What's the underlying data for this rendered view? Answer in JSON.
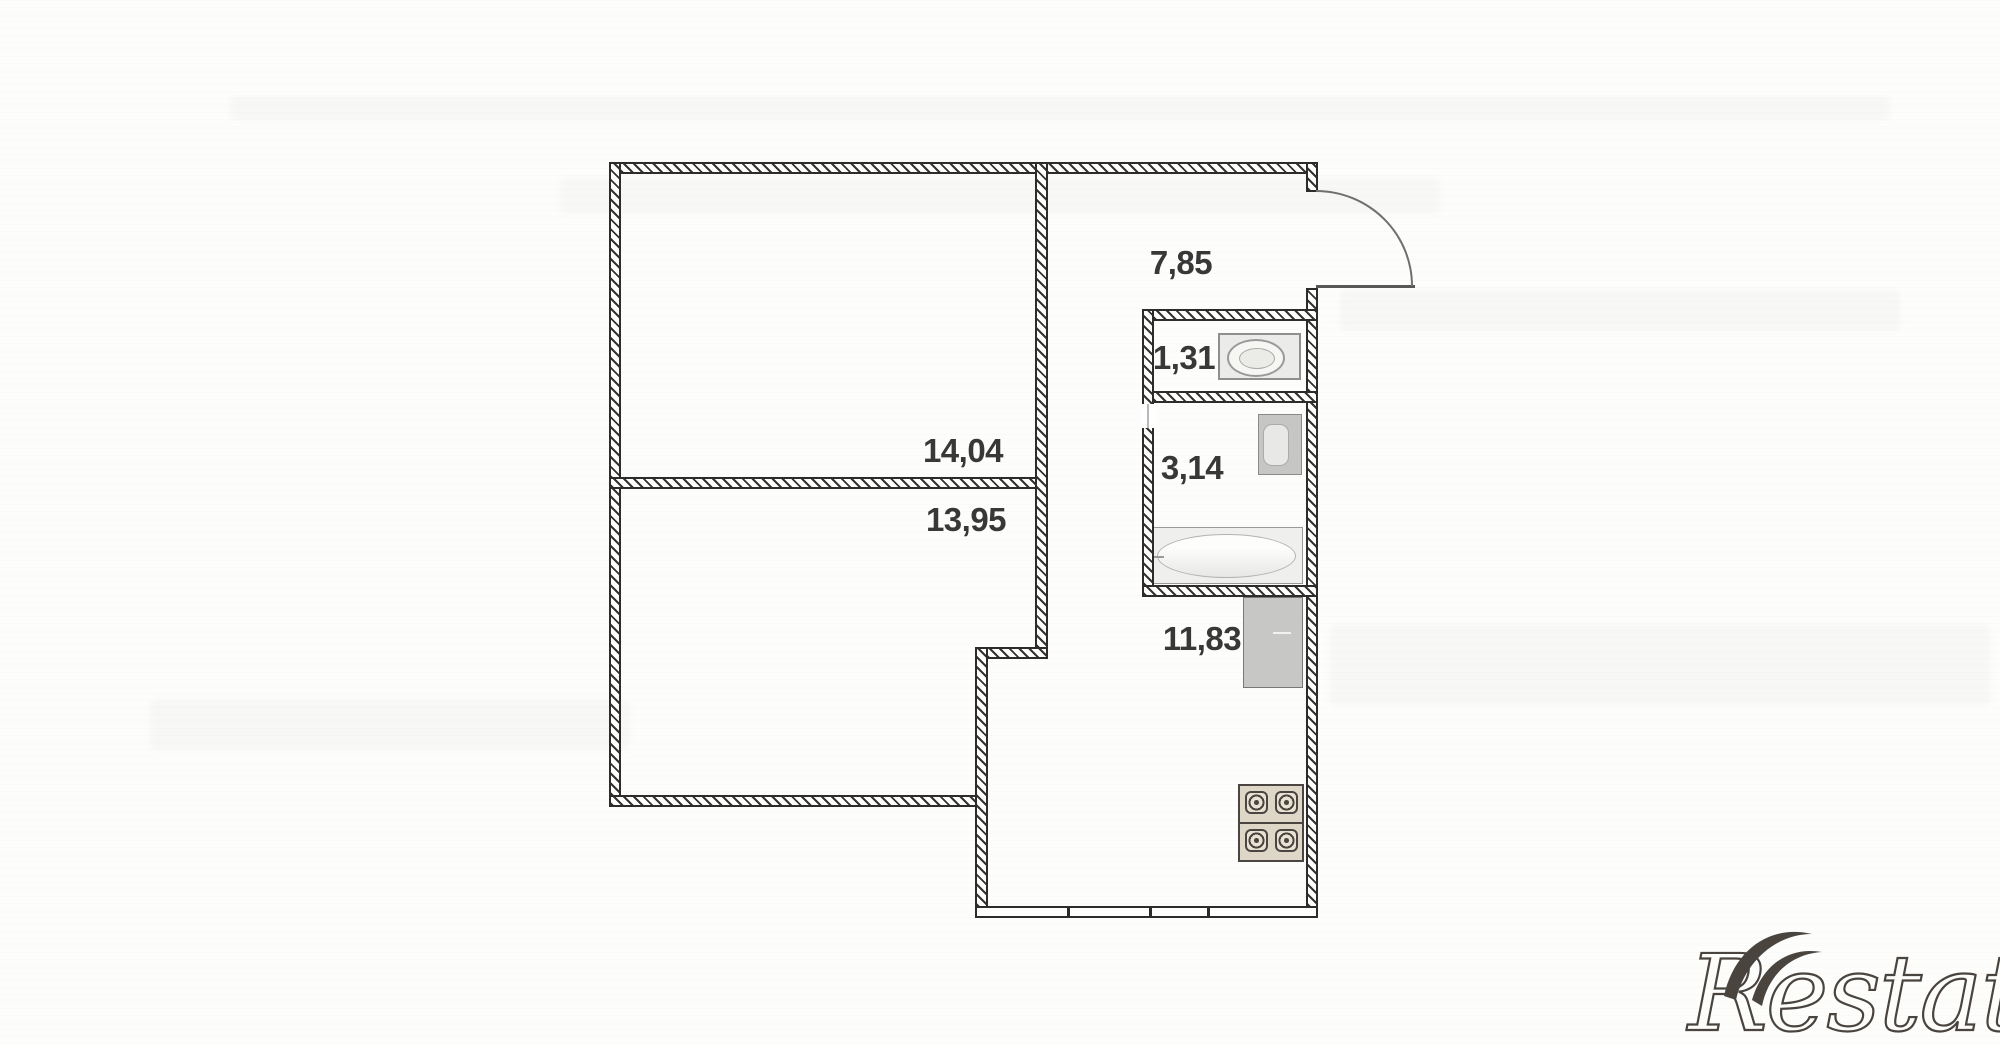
{
  "plan": {
    "rooms": [
      {
        "name": "hallway",
        "area": "7,85"
      },
      {
        "name": "wc",
        "area": "1,31"
      },
      {
        "name": "bathroom",
        "area": "3,14"
      },
      {
        "name": "room-1",
        "area": "14,04"
      },
      {
        "name": "room-2",
        "area": "13,95"
      },
      {
        "name": "kitchen",
        "area": "11,83"
      }
    ],
    "icons": {
      "toilet": "toilet-icon",
      "sink": "sink-icon",
      "bathtub": "bathtub-icon",
      "fridge": "fridge-icon",
      "stove": "stove-icon",
      "entry_door": "door-swing-icon"
    },
    "colors": {
      "wall_line": "#2e2c2a",
      "label_text": "#383838",
      "fixture_gray": "#c7c7c5",
      "stove_beige": "#ded7c8",
      "watermark": "#4a443f"
    }
  },
  "watermark": {
    "text": "Restate"
  }
}
